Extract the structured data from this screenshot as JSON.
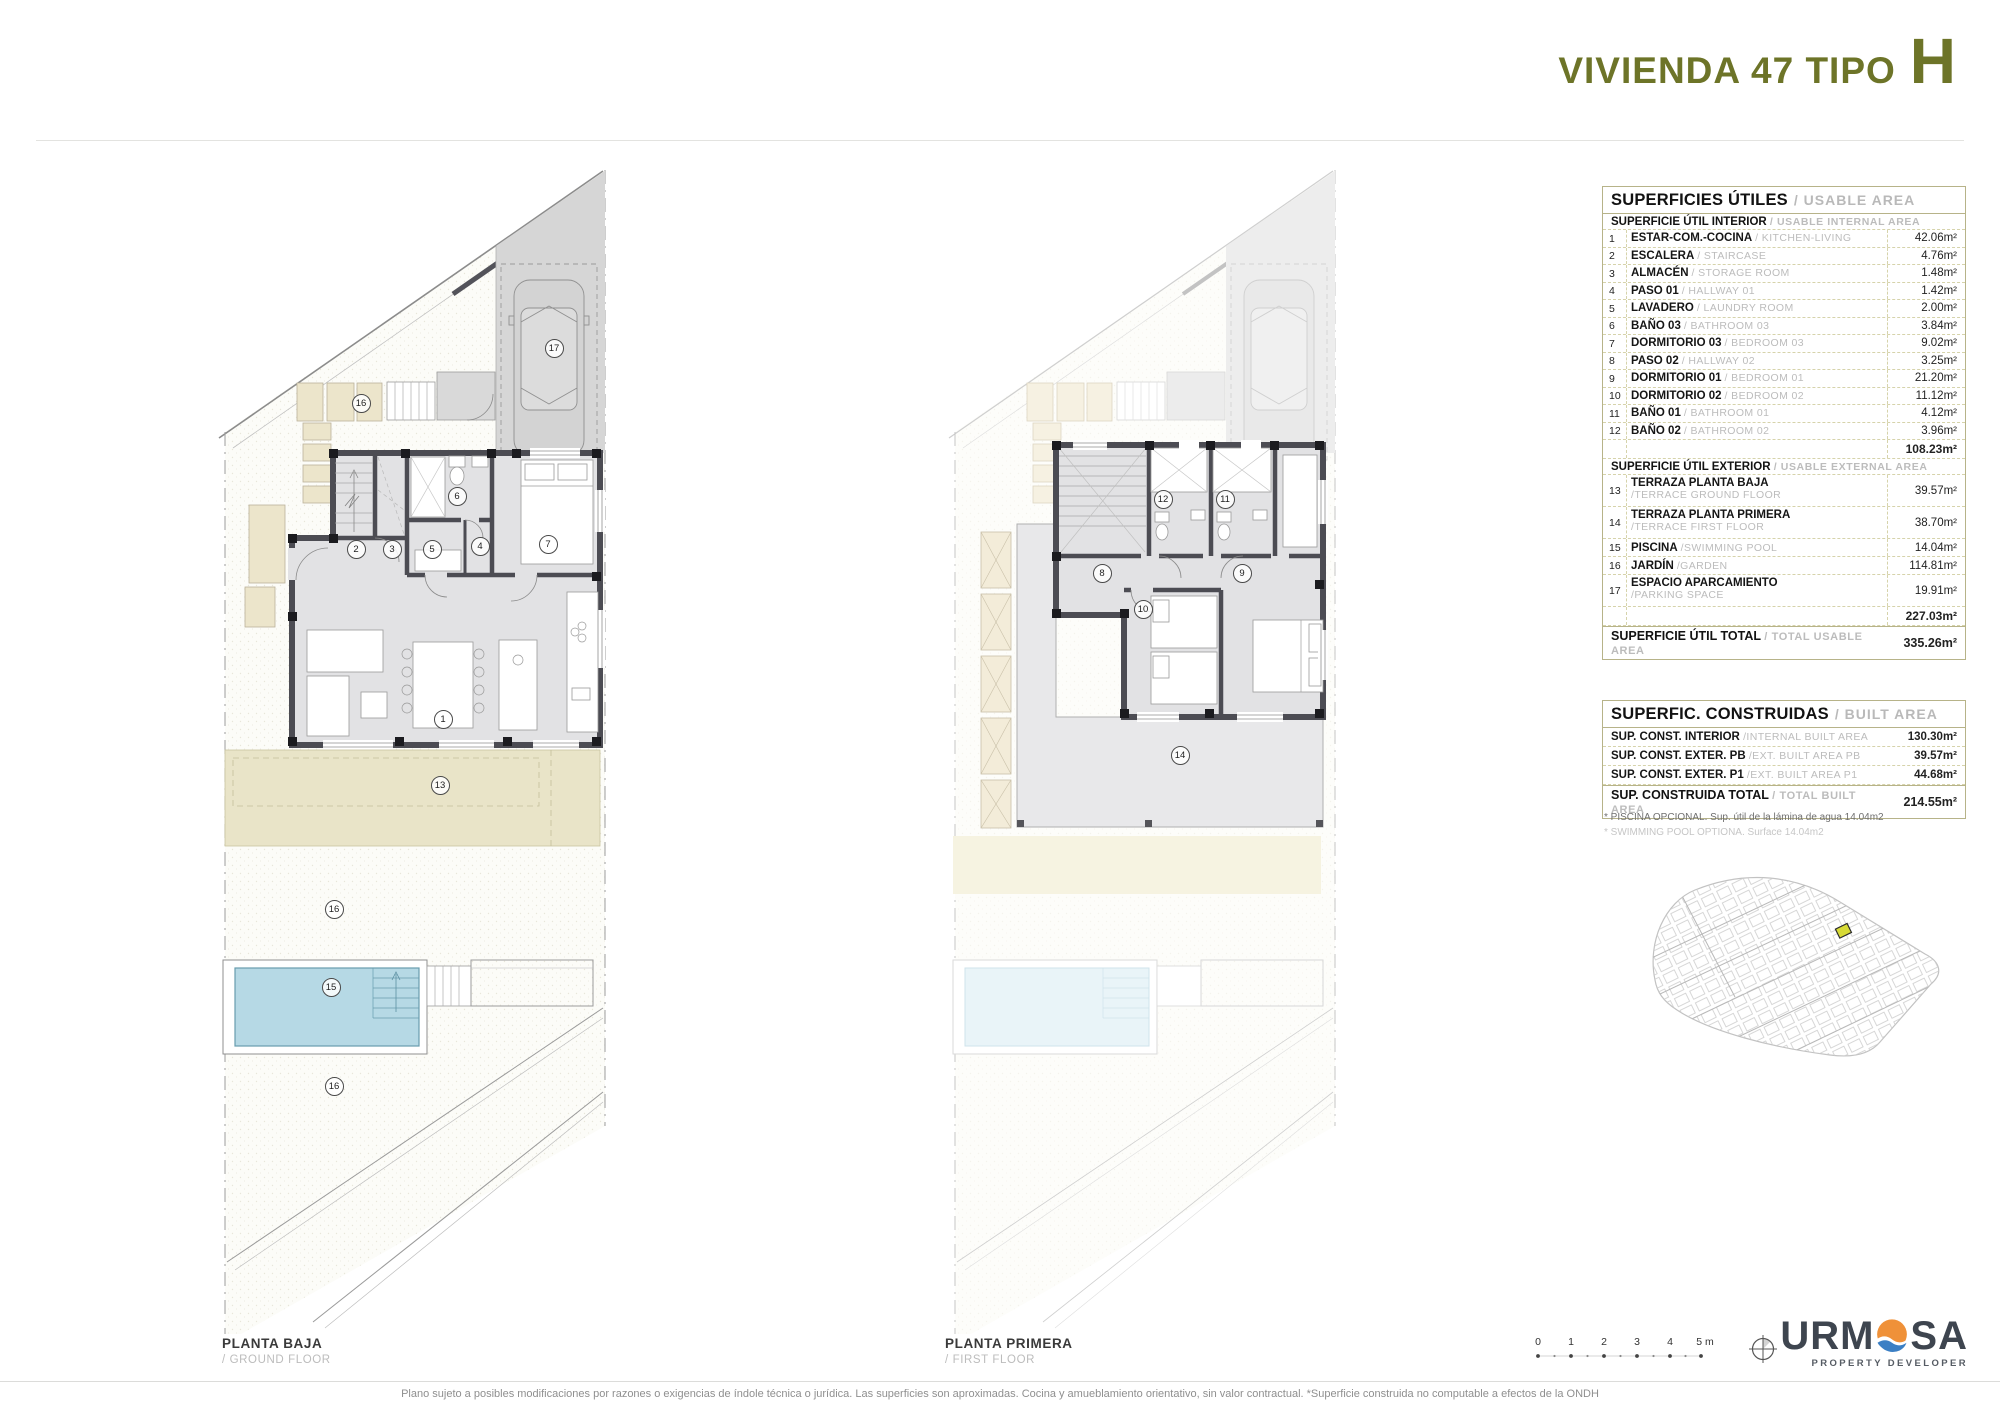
{
  "header": {
    "title_prefix": "VIVIENDA 47 TIPO",
    "title_letter": "H"
  },
  "usable_area": {
    "title_es": "SUPERFICIES ÚTILES",
    "title_en": "/ USABLE AREA",
    "interior": {
      "header_es": "SUPERFICIE ÚTIL INTERIOR",
      "header_en": "/ USABLE INTERNAL AREA",
      "rows": [
        {
          "num": "1",
          "es": "ESTAR-COM.-COCINA",
          "en": "/ KITCHEN-LIVING",
          "value": "42.06m²"
        },
        {
          "num": "2",
          "es": "ESCALERA",
          "en": "/ STAIRCASE",
          "value": "4.76m²"
        },
        {
          "num": "3",
          "es": "ALMACÉN",
          "en": "/ STORAGE ROOM",
          "value": "1.48m²"
        },
        {
          "num": "4",
          "es": "PASO 01",
          "en": "/ HALLWAY  01",
          "value": "1.42m²"
        },
        {
          "num": "5",
          "es": "LAVADERO",
          "en": "/ LAUNDRY ROOM",
          "value": "2.00m²"
        },
        {
          "num": "6",
          "es": "BAÑO 03",
          "en": "/ BATHROOM 03",
          "value": "3.84m²"
        },
        {
          "num": "7",
          "es": "DORMITORIO 03",
          "en": "/ BEDROOM 03",
          "value": "9.02m²"
        },
        {
          "num": "8",
          "es": "PASO 02",
          "en": "/ HALLWAY 02",
          "value": "3.25m²"
        },
        {
          "num": "9",
          "es": "DORMITORIO 01",
          "en": "/ BEDROOM 01",
          "value": "21.20m²"
        },
        {
          "num": "10",
          "es": "DORMITORIO 02",
          "en": "/ BEDROOM 02",
          "value": "11.12m²"
        },
        {
          "num": "11",
          "es": "BAÑO 01",
          "en": "/ BATHROOM 01",
          "value": "4.12m²"
        },
        {
          "num": "12",
          "es": "BAÑO 02",
          "en": "/ BATHROOM 02",
          "value": "3.96m²"
        }
      ],
      "subtotal": "108.23m²"
    },
    "exterior": {
      "header_es": "SUPERFICIE ÚTIL EXTERIOR",
      "header_en": "/ USABLE EXTERNAL AREA",
      "rows": [
        {
          "num": "13",
          "es": "TERRAZA PLANTA BAJA",
          "en": "/TERRACE GROUND FLOOR",
          "value": "39.57m²"
        },
        {
          "num": "14",
          "es": "TERRAZA PLANTA PRIMERA",
          "en": "/TERRACE FIRST FLOOR",
          "value": "38.70m²"
        },
        {
          "num": "15",
          "es": "PISCINA",
          "en": "/SWIMMING POOL",
          "value": "14.04m²"
        },
        {
          "num": "16",
          "es": "JARDÍN",
          "en": "/GARDEN",
          "value": "114.81m²"
        },
        {
          "num": "17",
          "es": "ESPACIO APARCAMIENTO",
          "en": "/PARKING SPACE",
          "value": "19.91m²"
        }
      ],
      "subtotal": "227.03m²"
    },
    "total": {
      "es": "SUPERFICIE ÚTIL TOTAL",
      "en": "/ TOTAL USABLE AREA",
      "value": "335.26m²"
    }
  },
  "built_area": {
    "title_es": "SUPERFIC. CONSTRUIDAS",
    "title_en": "/ BUILT AREA",
    "rows": [
      {
        "es": "SUP. CONST. INTERIOR",
        "en": "/INTERNAL BUILT AREA",
        "value": "130.30m²"
      },
      {
        "es": "SUP. CONST. EXTER. PB",
        "en": "/EXT. BUILT AREA PB",
        "value": "39.57m²"
      },
      {
        "es": "SUP. CONST. EXTER. P1",
        "en": "/EXT. BUILT AREA P1",
        "value": "44.68m²"
      }
    ],
    "total": {
      "es": "SUP. CONSTRUIDA TOTAL",
      "en": "/ TOTAL BUILT AREA",
      "value": "214.55m²"
    },
    "note_es": "* PISCINA OPCIONAL. Sup. útil de la lámina de agua 14.04m2",
    "note_en": "* SWIMMING POOL OPTIONA. Surface 14.04m2"
  },
  "plans": {
    "ground": {
      "label": "PLANTA BAJA",
      "sublabel": "/ GROUND FLOOR",
      "markers": [
        {
          "n": "17"
        },
        {
          "n": "16"
        },
        {
          "n": "6"
        },
        {
          "n": "7"
        },
        {
          "n": "2"
        },
        {
          "n": "3"
        },
        {
          "n": "5"
        },
        {
          "n": "4"
        },
        {
          "n": "1"
        },
        {
          "n": "13"
        },
        {
          "n": "16"
        },
        {
          "n": "15"
        },
        {
          "n": "16"
        }
      ]
    },
    "first": {
      "label": "PLANTA PRIMERA",
      "sublabel": "/ FIRST FLOOR",
      "markers": [
        {
          "n": "12"
        },
        {
          "n": "11"
        },
        {
          "n": "8"
        },
        {
          "n": "9"
        },
        {
          "n": "10"
        },
        {
          "n": "14"
        }
      ]
    }
  },
  "scale_bar": {
    "ticks": [
      "0",
      "1",
      "2",
      "3",
      "4"
    ],
    "last": "5 m"
  },
  "logo": {
    "left": "URM",
    "right": "SA",
    "subtitle": "PROPERTY DEVELOPER"
  },
  "footer": {
    "disclaimer": "Plano sujeto a posibles modificaciones por razones o exigencias de índole técnica o jurídica. Las superficies son aproximadas. Cocina y amueblamiento orientativo, sin valor contractual. *Superficie construida no computable a efectos de la ONDH"
  },
  "colors": {
    "accent_olive": "#6d7428",
    "table_line": "#b7b389",
    "terrace": "#e9e4c8",
    "pool": "#b6d9e5",
    "wall": "#4c4c53",
    "highlight_plot": "#d7da36",
    "logo_sun": "#ef9139",
    "logo_wave": "#3b7fc4"
  }
}
